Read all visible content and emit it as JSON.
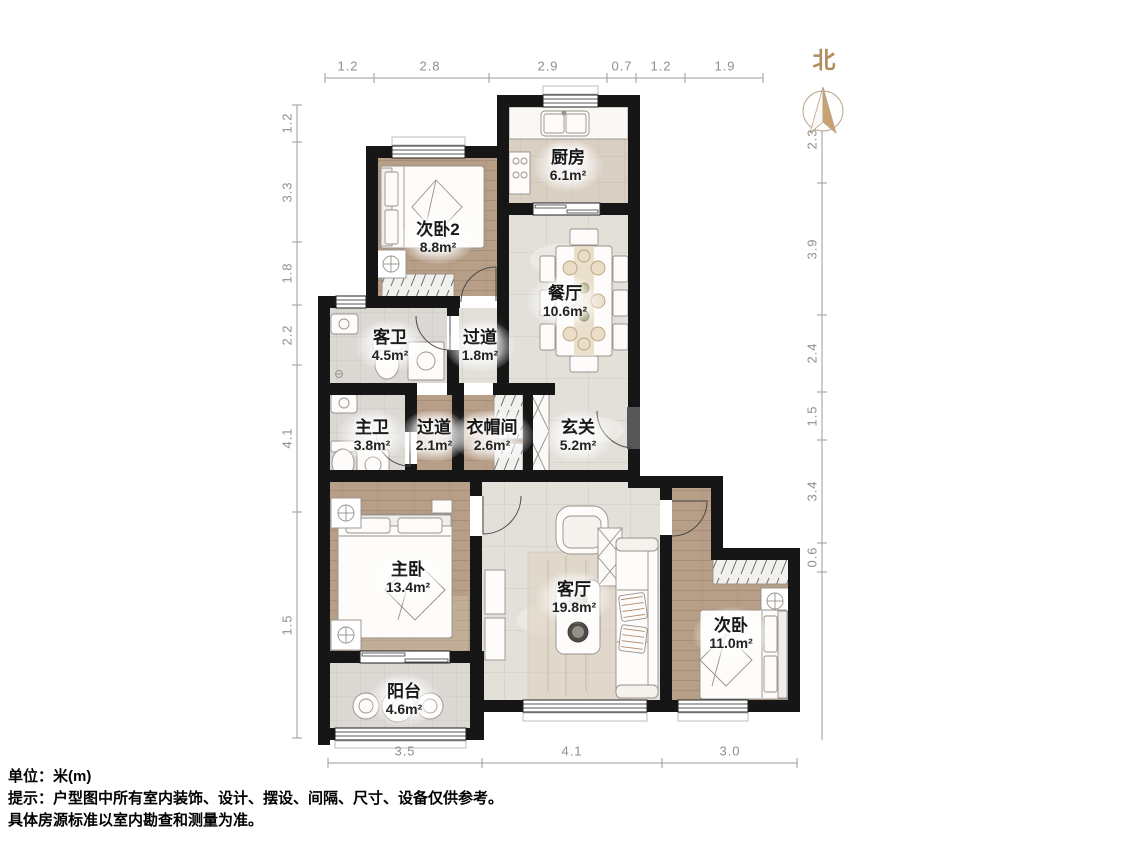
{
  "compass": {
    "label": "北"
  },
  "rooms": [
    {
      "id": "kitchen",
      "name": "厨房",
      "area": "6.1m²"
    },
    {
      "id": "bedroom2",
      "name": "次卧2",
      "area": "8.8m²"
    },
    {
      "id": "dining",
      "name": "餐厅",
      "area": "10.6m²"
    },
    {
      "id": "guest-bath",
      "name": "客卫",
      "area": "4.5m²"
    },
    {
      "id": "hallway-north",
      "name": "过道",
      "area": "1.8m²"
    },
    {
      "id": "master-bath",
      "name": "主卫",
      "area": "3.8m²"
    },
    {
      "id": "hallway-south",
      "name": "过道",
      "area": "2.1m²"
    },
    {
      "id": "cloakroom",
      "name": "衣帽间",
      "area": "2.6m²"
    },
    {
      "id": "foyer",
      "name": "玄关",
      "area": "5.2m²"
    },
    {
      "id": "master-bedroom",
      "name": "主卧",
      "area": "13.4m²"
    },
    {
      "id": "living-room",
      "name": "客厅",
      "area": "19.8m²"
    },
    {
      "id": "bedroom",
      "name": "次卧",
      "area": "11.0m²"
    },
    {
      "id": "balcony",
      "name": "阳台",
      "area": "4.6m²"
    }
  ],
  "dimensions": {
    "top": [
      "1.2",
      "2.8",
      "2.9",
      "0.7",
      "1.2",
      "1.9"
    ],
    "left": [
      "1.2",
      "3.3",
      "1.8",
      "2.2",
      "4.1",
      "1.5"
    ],
    "right": [
      "2.3",
      "3.9",
      "2.4",
      "1.5",
      "3.4",
      "0.6"
    ],
    "bottom": [
      "3.5",
      "4.1",
      "3.0"
    ]
  },
  "notes": {
    "unit": "单位：米(m)",
    "tip_line1": "提示：户型图中所有室内装饰、设计、摆设、间隔、尺寸、设备仅供参考。",
    "tip_line2": "具体房源标准以室内勘查和测量为准。"
  },
  "colors": {
    "wall": "#161616",
    "wood": "#b79e86",
    "tile": "#e3e0da",
    "accent": "#c8a272",
    "dim_text": "#8f8f8f"
  }
}
